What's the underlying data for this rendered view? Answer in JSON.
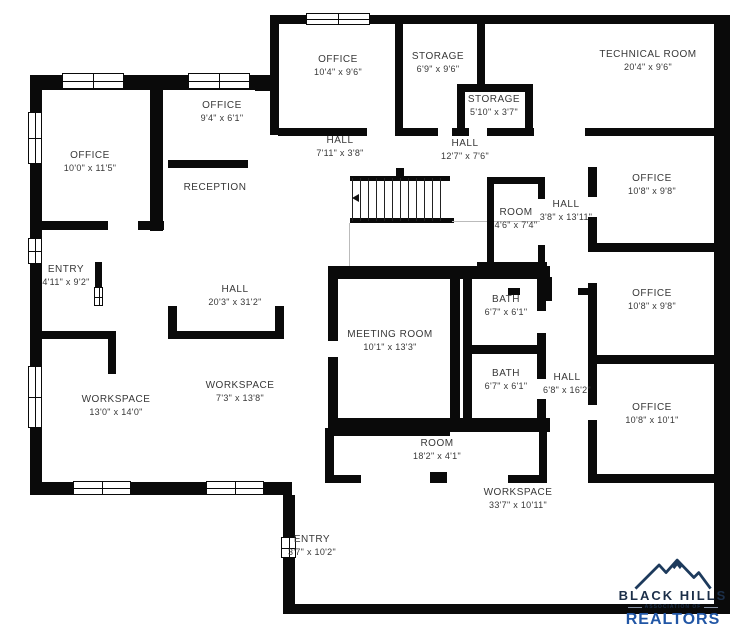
{
  "canvas": {
    "background": "#ffffff",
    "wall_color": "#0a0a0a",
    "label_color": "#383838"
  },
  "rooms": {
    "office_top": {
      "name": "OFFICE",
      "dims": "10'4\" x 9'6\""
    },
    "storage_large": {
      "name": "STORAGE",
      "dims": "6'9\" x 9'6\""
    },
    "storage_small": {
      "name": "STORAGE",
      "dims": "5'10\" x 3'7\""
    },
    "technical_room": {
      "name": "TECHNICAL ROOM",
      "dims": "20'4\" x 9'6\""
    },
    "hall_top_left": {
      "name": "HALL",
      "dims": "7'11\" x 3'8\""
    },
    "hall_top_right": {
      "name": "HALL",
      "dims": "12'7\" x 7'6\""
    },
    "office_small": {
      "name": "OFFICE",
      "dims": "9'4\" x 6'1\""
    },
    "office_left": {
      "name": "OFFICE",
      "dims": "10'0\" x 11'5\""
    },
    "reception": {
      "name": "RECEPTION",
      "dims": ""
    },
    "room_small": {
      "name": "ROOM",
      "dims": "4'6\" x 7'4\""
    },
    "hall_right_upper": {
      "name": "HALL",
      "dims": "3'8\" x 13'11\""
    },
    "office_right_1": {
      "name": "OFFICE",
      "dims": "10'8\" x 9'8\""
    },
    "office_right_2": {
      "name": "OFFICE",
      "dims": "10'8\" x 9'8\""
    },
    "office_right_3": {
      "name": "OFFICE",
      "dims": "10'8\" x 10'1\""
    },
    "hall_right_lower": {
      "name": "HALL",
      "dims": "6'8\" x 16'2\""
    },
    "entry_left": {
      "name": "ENTRY",
      "dims": "4'11\" x 9'2\""
    },
    "hall_center": {
      "name": "HALL",
      "dims": "20'3\" x 31'2\""
    },
    "meeting_room": {
      "name": "MEETING ROOM",
      "dims": "10'1\" x 13'3\""
    },
    "bath_upper": {
      "name": "BATH",
      "dims": "6'7\" x 6'1\""
    },
    "bath_lower": {
      "name": "BATH",
      "dims": "6'7\" x 6'1\""
    },
    "workspace_left": {
      "name": "WORKSPACE",
      "dims": "13'0\" x 14'0\""
    },
    "workspace_center": {
      "name": "WORKSPACE",
      "dims": "7'3\" x 13'8\""
    },
    "room_long": {
      "name": "ROOM",
      "dims": "18'2\" x 4'1\""
    },
    "workspace_bottom": {
      "name": "WORKSPACE",
      "dims": "33'7\" x 10'11\""
    },
    "entry_bottom": {
      "name": "ENTRY",
      "dims": "3'7\" x 10'2\""
    }
  },
  "logo": {
    "brand": "BLACK HILLS",
    "subtitle": "ASSOCIATION OF",
    "realtors": "REALTORS",
    "brand_color": "#1c2f49",
    "realtors_color": "#2156a5"
  }
}
